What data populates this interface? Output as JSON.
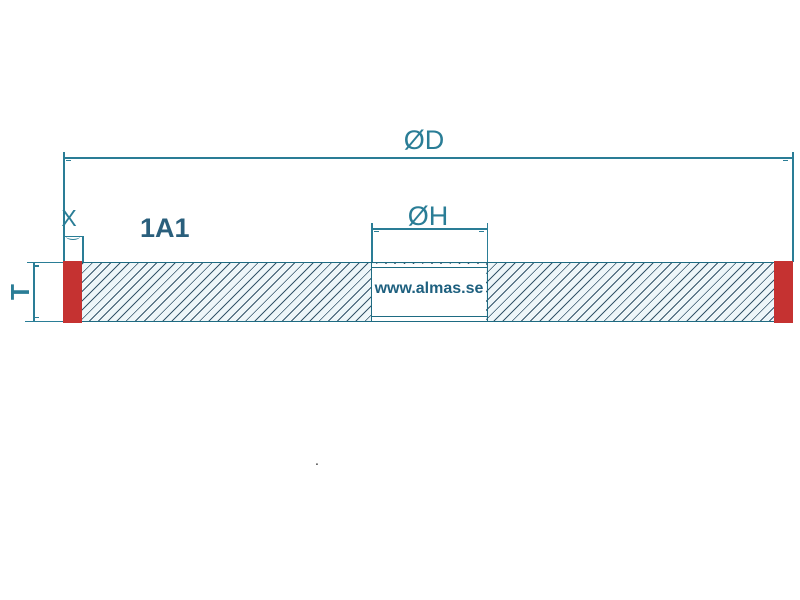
{
  "diagram": {
    "type_label": "1A1",
    "watermark": "www.almas.se",
    "stray_dot": ".",
    "labels": {
      "outer_diameter": "ØD",
      "hole_diameter": "ØH",
      "segment_width": "X",
      "thickness": "T"
    },
    "colors": {
      "dimension_line": "#2a7d96",
      "outline": "#1e6b82",
      "hatch_line": "#35556a",
      "hatch_background": "#eef6f9",
      "abrasive_segment": "#c53231",
      "label_text": "#2a7d96",
      "bold_text": "#2a5f7c",
      "watermark_text": "#1e607f",
      "page_background": "#ffffff"
    }
  }
}
